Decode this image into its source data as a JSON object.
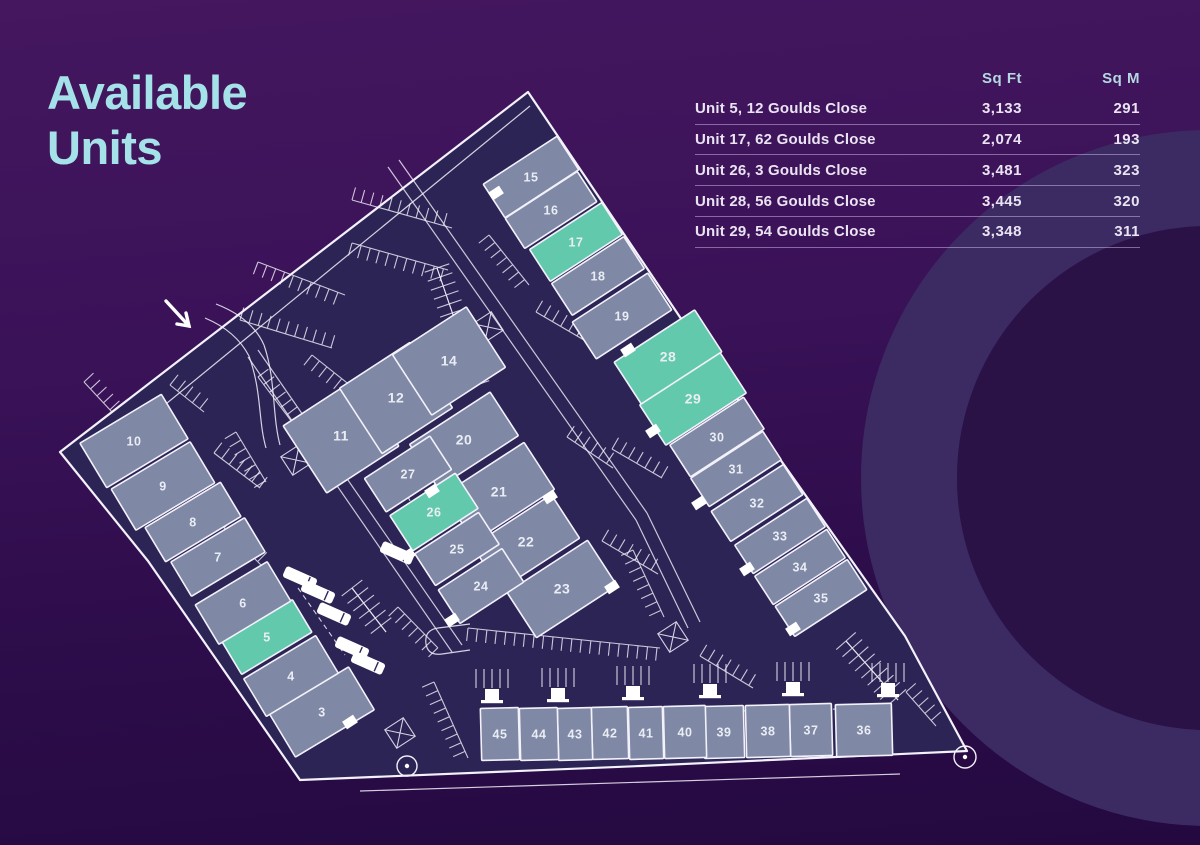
{
  "header": {
    "title_lines": [
      "Available",
      "Units"
    ]
  },
  "table": {
    "columns": [
      "Sq Ft",
      "Sq M"
    ],
    "rows": [
      {
        "label": "Unit 5, 12 Goulds Close",
        "sqft": "3,133",
        "sqm": "291"
      },
      {
        "label": "Unit 17, 62 Goulds Close",
        "sqft": "2,074",
        "sqm": "193"
      },
      {
        "label": "Unit 26, 3 Goulds Close",
        "sqft": "3,481",
        "sqm": "323"
      },
      {
        "label": "Unit 28, 56 Goulds Close",
        "sqft": "3,445",
        "sqm": "320"
      },
      {
        "label": "Unit 29, 54 Goulds Close",
        "sqft": "3,348",
        "sqm": "311"
      }
    ]
  },
  "colors": {
    "title": "#a5e1e8",
    "table_header": "#b5d8e0",
    "table_text": "#eae4f2",
    "divider": "#c8afd9",
    "ground": "#2d2456",
    "building": "#7f88a5",
    "available": "#62c9ad",
    "line": "#f3f1fa",
    "label": "#e9edf4",
    "ring_band": "#3c2b63",
    "ring_inner": "#2a1247"
  },
  "site_plan": {
    "available_units": [
      "5",
      "17",
      "26",
      "28",
      "29"
    ],
    "ring": {
      "cx": 1209,
      "cy": 478,
      "r_inner": 252,
      "r_band_mid": 300,
      "band_width": 96
    },
    "boundary": "528,92 688,329 905,636 967,751 640,766 300,780 148,561 60,452",
    "inner_lines": [
      [
        95,
        462,
        530,
        106
      ],
      [
        360,
        791,
        900,
        774
      ]
    ],
    "roads": [
      [
        388,
        167,
        636,
        520
      ],
      [
        399,
        160,
        647,
        513
      ],
      [
        636,
        520,
        688,
        628
      ],
      [
        647,
        513,
        700,
        622
      ],
      [
        258,
        350,
        462,
        645
      ],
      [
        248,
        357,
        452,
        652
      ]
    ],
    "curves": [
      "M205,318 Q236,331 249,356",
      "M216,304 Q252,318 264,345",
      "M249,356 C262,392 258,420 266,448",
      "M264,345 C276,380 272,415 280,445",
      "M470,624 L438,628 Q424,630 426,644 Q428,656 442,654 L470,650"
    ],
    "combs": [
      {
        "s": [
          240,
          320,
          332,
          348
        ],
        "d": -1
      },
      {
        "s": [
          258,
          262,
          345,
          295
        ],
        "d": 1
      },
      {
        "s": [
          352,
          200,
          452,
          228
        ],
        "d": -1
      },
      {
        "s": [
          352,
          243,
          448,
          270
        ],
        "d": 1
      },
      {
        "s": [
          437,
          268,
          477,
          385
        ],
        "d": -1
      },
      {
        "s": [
          437,
          268,
          477,
          385
        ],
        "d": 1
      },
      {
        "s": [
          489,
          235,
          529,
          285
        ],
        "d": 1
      },
      {
        "s": [
          536,
          312,
          596,
          347
        ],
        "d": -1
      },
      {
        "s": [
          567,
          437,
          613,
          468
        ],
        "d": -1
      },
      {
        "s": [
          612,
          449,
          662,
          478
        ],
        "d": -1
      },
      {
        "s": [
          602,
          541,
          658,
          574
        ],
        "d": -1
      },
      {
        "s": [
          633,
          550,
          664,
          617
        ],
        "d": 1
      },
      {
        "s": [
          312,
          355,
          356,
          390
        ],
        "d": 1
      },
      {
        "s": [
          258,
          377,
          292,
          422
        ],
        "d": -1
      },
      {
        "s": [
          236,
          432,
          266,
          482
        ],
        "d": 1
      },
      {
        "s": [
          170,
          385,
          204,
          412
        ],
        "d": -1
      },
      {
        "s": [
          214,
          453,
          260,
          488
        ],
        "d": -1
      },
      {
        "s": [
          224,
          528,
          262,
          566
        ],
        "d": -1
      },
      {
        "s": [
          352,
          588,
          386,
          632
        ],
        "d": -1
      },
      {
        "s": [
          352,
          588,
          386,
          632
        ],
        "d": 1
      },
      {
        "s": [
          398,
          607,
          438,
          648
        ],
        "d": 1
      },
      {
        "s": [
          468,
          628,
          660,
          648
        ],
        "d": 1
      },
      {
        "s": [
          700,
          656,
          753,
          688
        ],
        "d": -1
      },
      {
        "s": [
          846,
          641,
          898,
          700
        ],
        "d": -1
      },
      {
        "s": [
          846,
          641,
          898,
          700
        ],
        "d": 1
      },
      {
        "s": [
          434,
          682,
          468,
          758
        ],
        "d": 1
      },
      {
        "s": [
          84,
          382,
          112,
          412
        ],
        "d": -1
      },
      {
        "s": [
          906,
          692,
          936,
          726
        ],
        "d": -1
      }
    ],
    "xmarks": [
      [
        296,
        460
      ],
      [
        488,
        327
      ],
      [
        673,
        637
      ],
      [
        400,
        733
      ]
    ],
    "dashed": [
      [
        390,
        465,
        450,
        572
      ],
      [
        482,
        716,
        890,
        708
      ],
      [
        298,
        588,
        345,
        655
      ]
    ],
    "trucks": [
      [
        300,
        578
      ],
      [
        318,
        592
      ],
      [
        334,
        614
      ],
      [
        352,
        648
      ],
      [
        368,
        663
      ],
      [
        397,
        553
      ]
    ],
    "doors": [
      [
        628,
        350
      ],
      [
        653,
        431
      ],
      [
        699,
        503
      ],
      [
        747,
        569
      ],
      [
        793,
        629
      ],
      [
        496,
        193
      ],
      [
        550,
        497
      ],
      [
        408,
        555
      ],
      [
        432,
        491
      ],
      [
        452,
        620
      ],
      [
        612,
        587
      ],
      [
        350,
        722
      ]
    ],
    "gdoors": [
      [
        492,
        703
      ],
      [
        558,
        702
      ],
      [
        633,
        700
      ],
      [
        710,
        698
      ],
      [
        793,
        696
      ],
      [
        888,
        697
      ]
    ],
    "corner_circles": [
      [
        965,
        757,
        11
      ],
      [
        407,
        766,
        10
      ]
    ],
    "arrow": {
      "x1": 166,
      "y1": 301,
      "x2": 189,
      "y2": 326
    },
    "buildings": [
      {
        "n": "3",
        "x": 322,
        "y": 712,
        "w": 92,
        "h": 50,
        "a": -31
      },
      {
        "n": "4",
        "x": 291,
        "y": 676,
        "w": 84,
        "h": 44,
        "a": -31
      },
      {
        "n": "5",
        "x": 267,
        "y": 637,
        "w": 82,
        "h": 38,
        "a": -31,
        "hl": true
      },
      {
        "n": "6",
        "x": 243,
        "y": 603,
        "w": 84,
        "h": 46,
        "a": -31
      },
      {
        "n": "7",
        "x": 218,
        "y": 557,
        "w": 86,
        "h": 40,
        "a": -31
      },
      {
        "n": "8",
        "x": 193,
        "y": 522,
        "w": 88,
        "h": 40,
        "a": -31
      },
      {
        "n": "9",
        "x": 163,
        "y": 486,
        "w": 92,
        "h": 48,
        "a": -31
      },
      {
        "n": "10",
        "x": 134,
        "y": 441,
        "w": 95,
        "h": 52,
        "a": -31
      },
      {
        "n": "11",
        "x": 341,
        "y": 436,
        "w": 86,
        "h": 80,
        "a": -33,
        "big": true
      },
      {
        "n": "12",
        "x": 396,
        "y": 398,
        "w": 84,
        "h": 78,
        "a": -33,
        "big": true
      },
      {
        "n": "14",
        "x": 449,
        "y": 361,
        "w": 88,
        "h": 72,
        "a": -33,
        "big": true
      },
      {
        "n": "15",
        "x": 531,
        "y": 177,
        "w": 88,
        "h": 40,
        "a": -33
      },
      {
        "n": "16",
        "x": 551,
        "y": 210,
        "w": 86,
        "h": 36,
        "a": -33
      },
      {
        "n": "17",
        "x": 576,
        "y": 242,
        "w": 86,
        "h": 38,
        "a": -33,
        "hl": true
      },
      {
        "n": "18",
        "x": 598,
        "y": 276,
        "w": 86,
        "h": 38,
        "a": -33
      },
      {
        "n": "19",
        "x": 622,
        "y": 316,
        "w": 90,
        "h": 44,
        "a": -33
      },
      {
        "n": "20",
        "x": 464,
        "y": 440,
        "w": 96,
        "h": 52,
        "a": -33,
        "big": true
      },
      {
        "n": "21",
        "x": 499,
        "y": 492,
        "w": 96,
        "h": 56,
        "a": -33,
        "big": true
      },
      {
        "n": "22",
        "x": 526,
        "y": 542,
        "w": 94,
        "h": 52,
        "a": -33,
        "big": true
      },
      {
        "n": "23",
        "x": 562,
        "y": 589,
        "w": 96,
        "h": 54,
        "a": -33,
        "big": true
      },
      {
        "n": "24",
        "x": 481,
        "y": 586,
        "w": 76,
        "h": 40,
        "a": -33
      },
      {
        "n": "25",
        "x": 457,
        "y": 549,
        "w": 76,
        "h": 38,
        "a": -33
      },
      {
        "n": "26",
        "x": 434,
        "y": 512,
        "w": 78,
        "h": 42,
        "a": -33,
        "hl": true
      },
      {
        "n": "27",
        "x": 408,
        "y": 474,
        "w": 78,
        "h": 40,
        "a": -33
      },
      {
        "n": "28",
        "x": 668,
        "y": 357,
        "w": 96,
        "h": 50,
        "a": -33,
        "hl": true,
        "big": true
      },
      {
        "n": "29",
        "x": 693,
        "y": 399,
        "w": 96,
        "h": 48,
        "a": -33,
        "hl": true,
        "big": true
      },
      {
        "n": "30",
        "x": 717,
        "y": 437,
        "w": 88,
        "h": 38,
        "a": -33
      },
      {
        "n": "31",
        "x": 736,
        "y": 469,
        "w": 86,
        "h": 34,
        "a": -33
      },
      {
        "n": "32",
        "x": 757,
        "y": 503,
        "w": 86,
        "h": 36,
        "a": -33
      },
      {
        "n": "33",
        "x": 780,
        "y": 536,
        "w": 86,
        "h": 34,
        "a": -33
      },
      {
        "n": "34",
        "x": 800,
        "y": 567,
        "w": 86,
        "h": 34,
        "a": -33
      },
      {
        "n": "35",
        "x": 821,
        "y": 598,
        "w": 86,
        "h": 36,
        "a": -33
      },
      {
        "n": "36",
        "x": 864,
        "y": 730,
        "w": 56,
        "h": 52,
        "a": -1.5
      },
      {
        "n": "37",
        "x": 811,
        "y": 730,
        "w": 42,
        "h": 52,
        "a": -1.5
      },
      {
        "n": "38",
        "x": 768,
        "y": 731,
        "w": 44,
        "h": 52,
        "a": -1.5
      },
      {
        "n": "39",
        "x": 724,
        "y": 732,
        "w": 40,
        "h": 52,
        "a": -1.5
      },
      {
        "n": "40",
        "x": 685,
        "y": 732,
        "w": 42,
        "h": 52,
        "a": -1.5
      },
      {
        "n": "41",
        "x": 646,
        "y": 733,
        "w": 34,
        "h": 52,
        "a": -1.5
      },
      {
        "n": "42",
        "x": 610,
        "y": 733,
        "w": 36,
        "h": 52,
        "a": -1.5
      },
      {
        "n": "43",
        "x": 575,
        "y": 734,
        "w": 34,
        "h": 52,
        "a": -1.5
      },
      {
        "n": "44",
        "x": 539,
        "y": 734,
        "w": 38,
        "h": 52,
        "a": -1.5
      },
      {
        "n": "45",
        "x": 500,
        "y": 734,
        "w": 38,
        "h": 52,
        "a": -1.5
      }
    ]
  }
}
